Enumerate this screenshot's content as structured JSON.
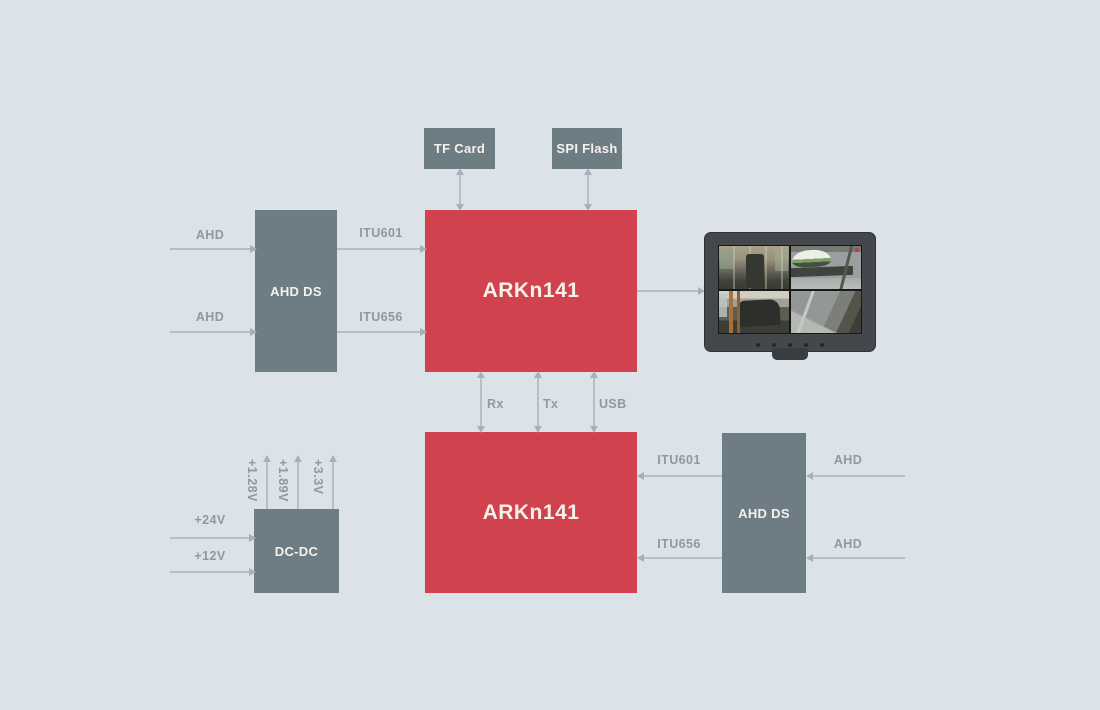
{
  "colors": {
    "background": "#dce3e8",
    "block_gray": "#6e7c83",
    "block_red": "#d0434e",
    "block_text": "#f5f2ec",
    "connector": "#b5bfc6",
    "connector_head": "#a6b0b8",
    "signal_text": "#8f99a1"
  },
  "blocks": {
    "tf_card": "TF Card",
    "spi_flash": "SPI Flash",
    "ahd_ds_left": "AHD DS",
    "soc_top": "ARKn141",
    "soc_bottom": "ARKn141",
    "ahd_ds_right": "AHD DS",
    "dc_dc": "DC-DC"
  },
  "signals": {
    "left_inputs": [
      "AHD",
      "AHD"
    ],
    "left_buses": [
      "ITU601",
      "ITU656"
    ],
    "interconnect": [
      "Rx",
      "Tx",
      "USB"
    ],
    "right_buses": [
      "ITU601",
      "ITU656"
    ],
    "right_inputs": [
      "AHD",
      "AHD"
    ],
    "power_inputs": [
      "+24V",
      "+12V"
    ],
    "power_rails": [
      "+1.28V",
      "+1.89V",
      "+3.3V"
    ]
  }
}
